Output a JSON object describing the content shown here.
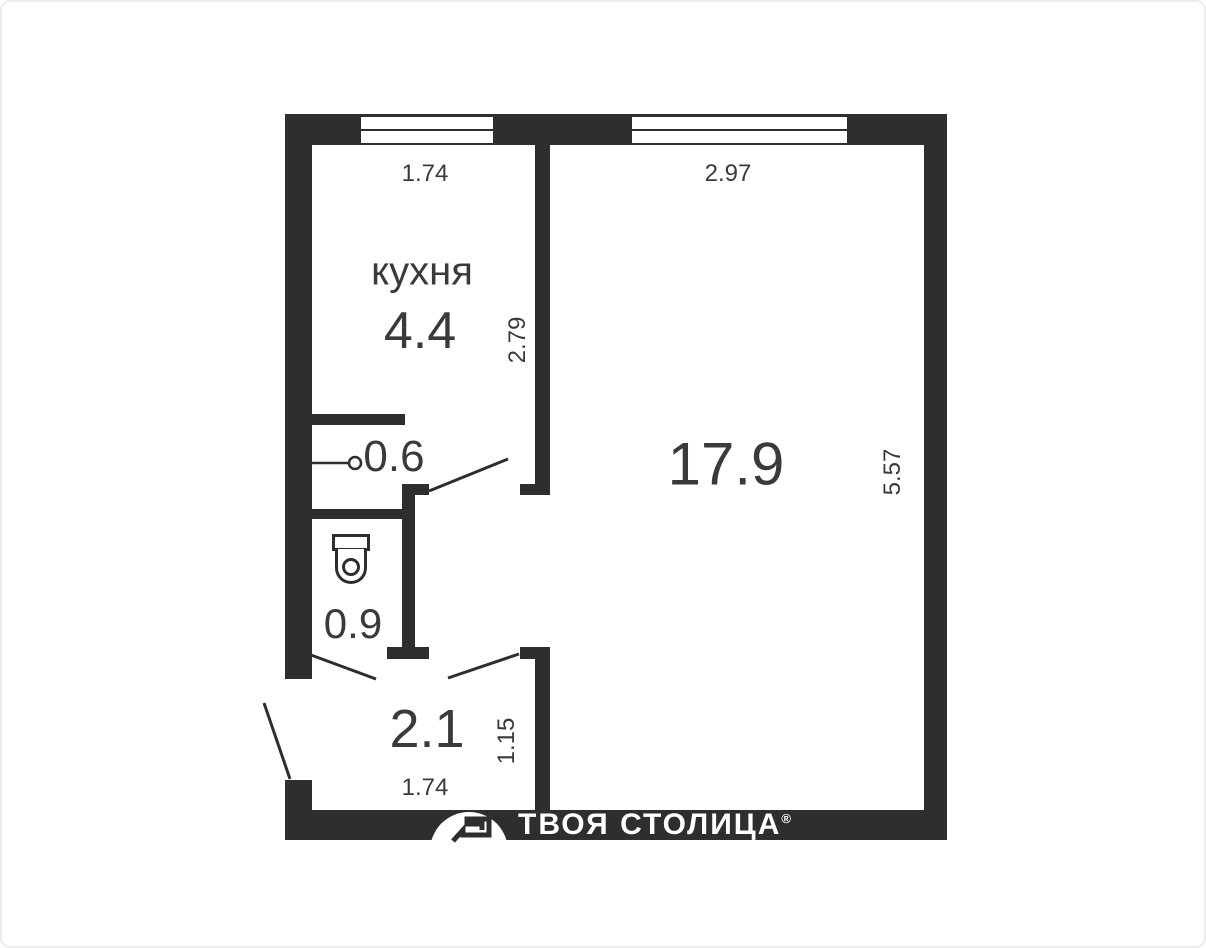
{
  "floor_plan": {
    "wall_color": "#2e2e2e",
    "text_color": "#3a3a3a",
    "labels": {
      "kitchen_name": "кухня",
      "kitchen_area": "4.4",
      "room_area": "17.9",
      "closet_area": "0.6",
      "bathroom_area": "0.9",
      "hallway_area": "2.1"
    },
    "dimensions": {
      "kitchen_width": "1.74",
      "room_width": "2.97",
      "kitchen_depth": "2.79",
      "room_depth": "5.57",
      "hallway_depth": "1.15",
      "hallway_width": "1.74"
    },
    "fixtures": {
      "toilet": "toilet"
    }
  },
  "branding": {
    "agency_name": "ТВОЯ СТОЛИЦА",
    "registered_mark": "®"
  }
}
